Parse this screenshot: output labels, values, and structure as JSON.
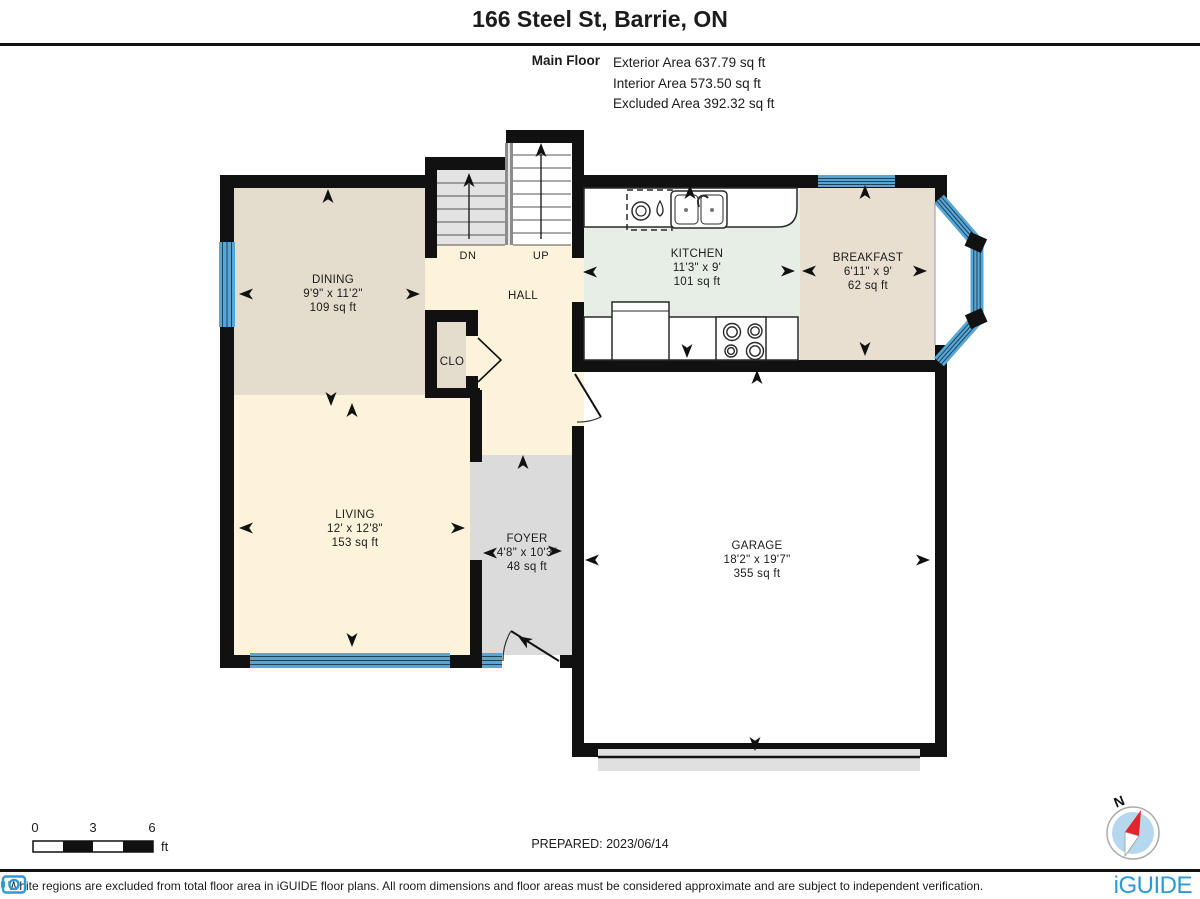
{
  "header": {
    "title": "166 Steel St, Barrie, ON",
    "floor_label": "Main Floor",
    "areas": [
      "Exterior Area 637.79 sq ft",
      "Interior Area 573.50 sq ft",
      "Excluded Area 392.32 sq ft"
    ]
  },
  "rooms": {
    "dining": {
      "name": "DINING",
      "dims": "9'9\" x 11'2\"",
      "area": "109 sq ft"
    },
    "living": {
      "name": "LIVING",
      "dims": "12' x 12'8\"",
      "area": "153 sq ft"
    },
    "kitchen": {
      "name": "KITCHEN",
      "dims": "11'3\" x 9'",
      "area": "101 sq ft"
    },
    "breakfast": {
      "name": "BREAKFAST",
      "dims": "6'11\" x 9'",
      "area": "62 sq ft"
    },
    "foyer": {
      "name": "FOYER",
      "dims": "4'8\" x 10'3\"",
      "area": "48 sq ft"
    },
    "garage": {
      "name": "GARAGE",
      "dims": "18'2\" x 19'7\"",
      "area": "355 sq ft"
    },
    "hall": {
      "name": "HALL"
    },
    "closet": {
      "name": "CLO"
    }
  },
  "stairs": {
    "down_label": "DN",
    "up_label": "UP"
  },
  "scale_bar": {
    "ticks": [
      "0",
      "3",
      "6"
    ],
    "unit": "ft"
  },
  "footer": {
    "prepared": "PREPARED: 2023/06/14",
    "disclaimer": "White regions are excluded from total floor area in iGUIDE floor plans. All room dimensions and floor areas must be considered approximate and are subject to independent verification.",
    "brand": "iGUIDE",
    "compass_label": "N"
  },
  "colors": {
    "wall": "#111111",
    "window_blue": "#56a7d8",
    "floor_dining": "#e4dccd",
    "floor_living_hall": "#fcf3da",
    "floor_kitchen": "#e6eee5",
    "floor_breakfast": "#e9dfd1",
    "floor_foyer": "#dbdbdb",
    "floor_garage": "#ffffff",
    "stairs_down_gray": "#e3e3e3",
    "brand_blue": "#2a9cd5",
    "compass_fill": "#b5d8ee",
    "needle_red": "#e3242b"
  }
}
